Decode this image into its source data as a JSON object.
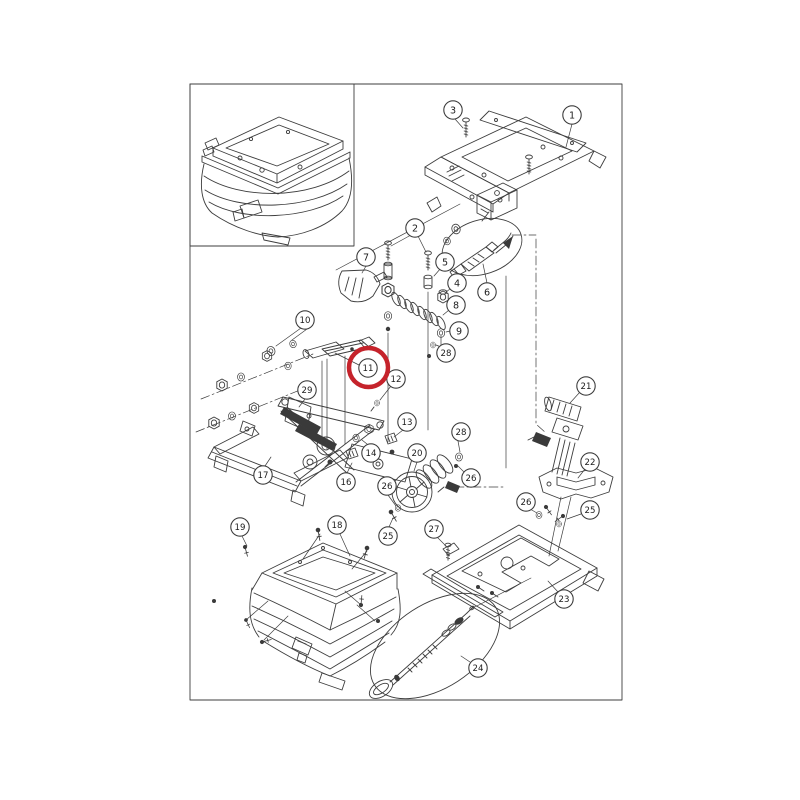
{
  "figure": {
    "type": "exploded-parts-diagram",
    "subject": "seat suspension assembly exploded view with inset assembled view",
    "background": "#ffffff",
    "line_color": "#3d3d3d",
    "frame": {
      "x": 190,
      "y": 84,
      "width": 432,
      "height": 616
    },
    "inset_frame": {
      "x": 190,
      "y": 84,
      "width": 164,
      "height": 162
    },
    "highlight": {
      "label": "11",
      "x": 368.5,
      "y": 367.5,
      "radius": 19.5,
      "color": "#c5232b",
      "stroke_width": 4.5
    },
    "balloon": {
      "radius": 9.2,
      "fill": "#ffffff",
      "text_color": "#1c1c1c"
    },
    "callouts": [
      {
        "label": "3",
        "x": 453,
        "y": 110
      },
      {
        "label": "1",
        "x": 572,
        "y": 115
      },
      {
        "label": "2",
        "x": 415,
        "y": 228
      },
      {
        "label": "7",
        "x": 366,
        "y": 257
      },
      {
        "label": "5",
        "x": 445,
        "y": 262
      },
      {
        "label": "4",
        "x": 457,
        "y": 283
      },
      {
        "label": "6",
        "x": 487,
        "y": 292
      },
      {
        "label": "8",
        "x": 456,
        "y": 305
      },
      {
        "label": "10",
        "x": 305,
        "y": 320
      },
      {
        "label": "9",
        "x": 459,
        "y": 331
      },
      {
        "label": "28",
        "x": 446,
        "y": 353
      },
      {
        "label": "11",
        "x": 368,
        "y": 368,
        "highlighted": true
      },
      {
        "label": "12",
        "x": 396,
        "y": 379
      },
      {
        "label": "21",
        "x": 586,
        "y": 386
      },
      {
        "label": "29",
        "x": 307,
        "y": 390
      },
      {
        "label": "13",
        "x": 407,
        "y": 422
      },
      {
        "label": "28",
        "x": 461,
        "y": 432
      },
      {
        "label": "20",
        "x": 417,
        "y": 453
      },
      {
        "label": "14",
        "x": 371,
        "y": 453
      },
      {
        "label": "22",
        "x": 590,
        "y": 462
      },
      {
        "label": "17",
        "x": 263,
        "y": 475
      },
      {
        "label": "26",
        "x": 471,
        "y": 478
      },
      {
        "label": "16",
        "x": 346,
        "y": 482
      },
      {
        "label": "26",
        "x": 387,
        "y": 486
      },
      {
        "label": "26",
        "x": 526,
        "y": 502
      },
      {
        "label": "25",
        "x": 590,
        "y": 510
      },
      {
        "label": "18",
        "x": 337,
        "y": 525
      },
      {
        "label": "19",
        "x": 240,
        "y": 527
      },
      {
        "label": "27",
        "x": 434,
        "y": 529
      },
      {
        "label": "25",
        "x": 388,
        "y": 536
      },
      {
        "label": "23",
        "x": 564,
        "y": 599
      },
      {
        "label": "24",
        "x": 478,
        "y": 668
      }
    ]
  }
}
